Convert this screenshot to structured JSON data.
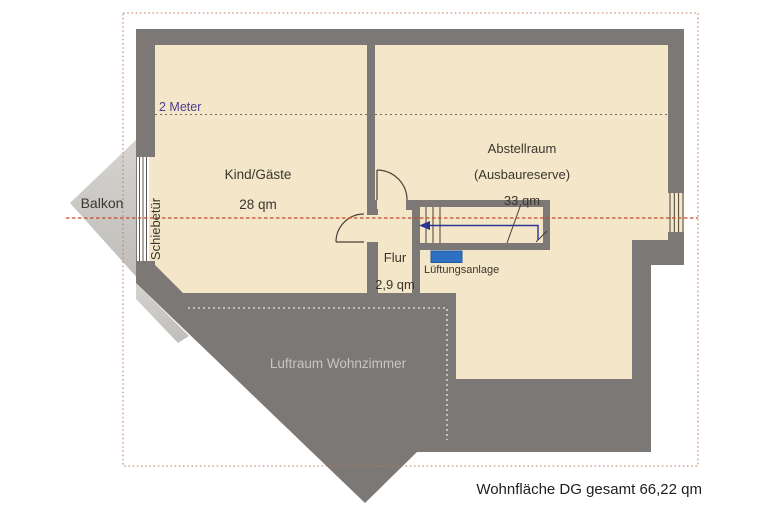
{
  "plan_title": "Dachgeschoss Grundriss",
  "footer": {
    "total": "Wohnfläche DG gesamt 66,22 qm"
  },
  "labels": {
    "two_meter": "2 Meter",
    "balkon": "Balkon",
    "schiebetuer": "Schiebetür",
    "luftraum": "Luftraum Wohnzimmer",
    "lueftungsanlage": "Lüftungsanlage"
  },
  "rooms": {
    "kind_gaeste": {
      "name": "Kind/Gäste",
      "area": "28 qm"
    },
    "abstellraum": {
      "name": "Abstellraum",
      "note": "(Ausbaureserve)",
      "area": "33 qm"
    },
    "flur": {
      "name": "Flur",
      "area": "2,9 qm"
    }
  },
  "colors": {
    "wall": "#7b7875",
    "floor": "#f4e6c8",
    "balcony_light": "#d6d4d0",
    "balcony_dark": "#bfbdb9",
    "border_dash": "#c07a5a",
    "section_line": "#c84a28",
    "meter_line": "#6b6b6b",
    "meter_text": "#4b3e8c",
    "luftraum_text": "#c9c6c1",
    "luftraum_dotted": "#d8d5d0",
    "vent_blue": "#2e70c2",
    "vent_border": "#245a9e",
    "stair_arrow": "#2b3490",
    "line_dark": "#474239",
    "ink": "#3a362f",
    "footer_text": "#1e1e1e",
    "sliding_door_bg": "#ffffff"
  }
}
